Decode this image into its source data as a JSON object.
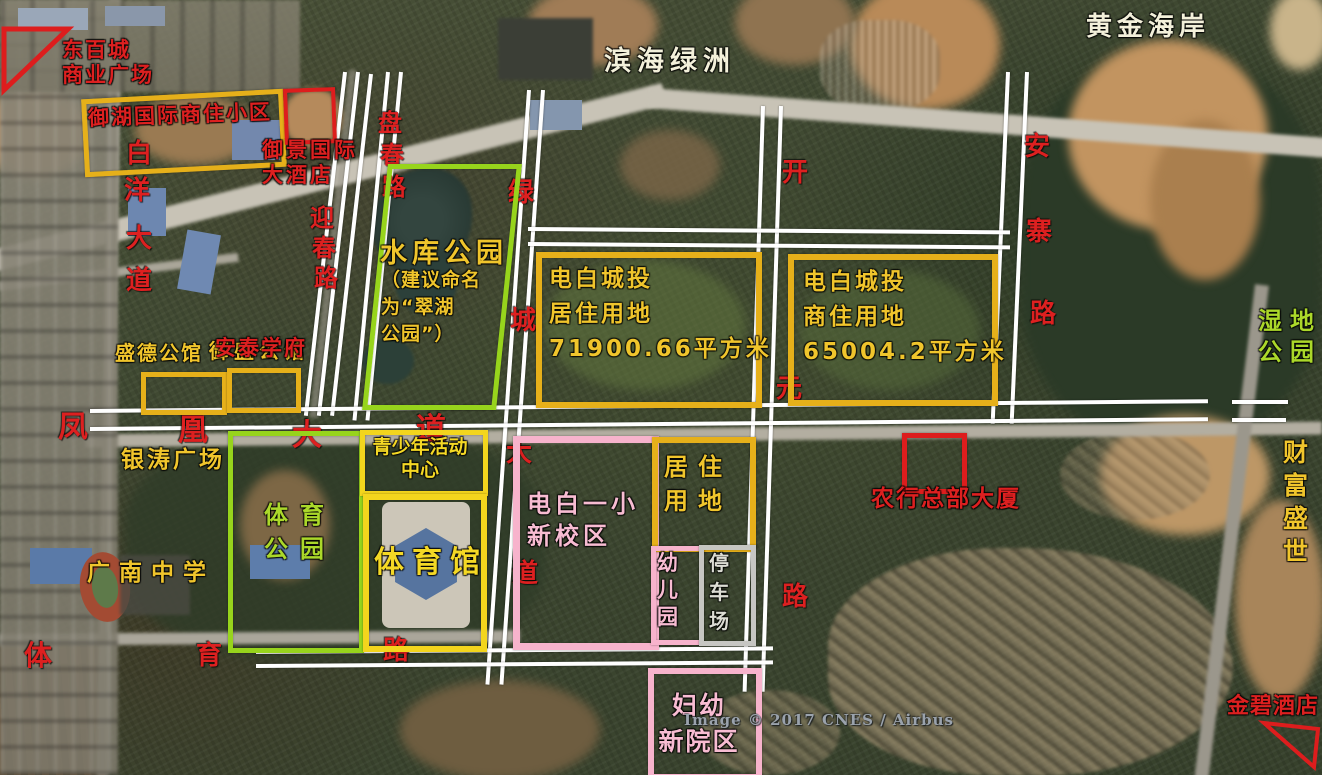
{
  "attribution": "Image © 2017 CNES / Airbus",
  "colors": {
    "parcel_gold": "#e6b01a",
    "parcel_bright_yellow": "#f3d51d",
    "parcel_green": "#97d41c",
    "parcel_pink": "#f7b3cc",
    "parcel_red": "#dd1d1d",
    "parcel_gray": "#c6c6c2",
    "label_red": "#dd2020",
    "label_yellow": "#f0c52c",
    "label_green": "#abd82a",
    "label_pink": "#f8bcd2",
    "label_white": "#f3f0da"
  },
  "labels": {
    "dongbaicheng": {
      "text": "东百城\n商业广场"
    },
    "yuhu": {
      "text": "御湖国际商住小区"
    },
    "yujing": {
      "text": "御景国际\n大酒店"
    },
    "binhai": {
      "text": "滨海绿洲"
    },
    "huangjin": {
      "text": "黄金海岸"
    },
    "shidi": {
      "text": "湿地\n公园"
    },
    "caifu": {
      "text": "财富盛世"
    },
    "shuiku_title": {
      "text": "水库公园"
    },
    "shuiku_note": {
      "text": "（建议命名\n为“翠湖\n公园”）"
    },
    "chengtou_residential": {
      "text": "电白城投\n居住用地\n71900.66平方米"
    },
    "chengtou_commercial": {
      "text": "电白城投\n商住用地\n65004.2平方米"
    },
    "shengde": {
      "text": "盛德公馆"
    },
    "yusheng": {
      "text": "御盛公馆"
    },
    "antai": {
      "text": "安泰学府"
    },
    "yintao": {
      "text": "银涛广场"
    },
    "tiyu_park": {
      "text": "体育\n公园"
    },
    "qingshaonian": {
      "text": "青少年活动\n中心"
    },
    "tiyuguan": {
      "text": "体育馆"
    },
    "yixiao": {
      "text": "电白一小\n新校区"
    },
    "juzhu": {
      "text": "居住\n用地"
    },
    "youeryuan": {
      "text": "幼儿园"
    },
    "tingchechang": {
      "text": "停车场"
    },
    "nonghang": {
      "text": "农行总部大厦"
    },
    "guangnan": {
      "text": "广南中学"
    },
    "fuyou": {
      "text": "妇幼\n新院区"
    },
    "jinbi": {
      "text": "金碧酒店"
    }
  },
  "roads": {
    "baiyang": {
      "chars": [
        "白",
        "洋",
        "大",
        "道"
      ]
    },
    "yingchun": {
      "chars": [
        "迎",
        "春",
        "路"
      ]
    },
    "panchun": {
      "chars": [
        "盘",
        "春",
        "路"
      ]
    },
    "lucheng": {
      "chars": [
        "绿",
        "城",
        "大",
        "道"
      ]
    },
    "kaiyuan": {
      "chars": [
        "开",
        "元",
        "路"
      ]
    },
    "anzhai": {
      "chars": [
        "安",
        "寨",
        "路"
      ]
    },
    "fenghuang": {
      "chars": [
        "凤",
        "凰",
        "大",
        "道"
      ]
    },
    "tiyu": {
      "chars": [
        "体",
        "育",
        "路"
      ]
    }
  }
}
